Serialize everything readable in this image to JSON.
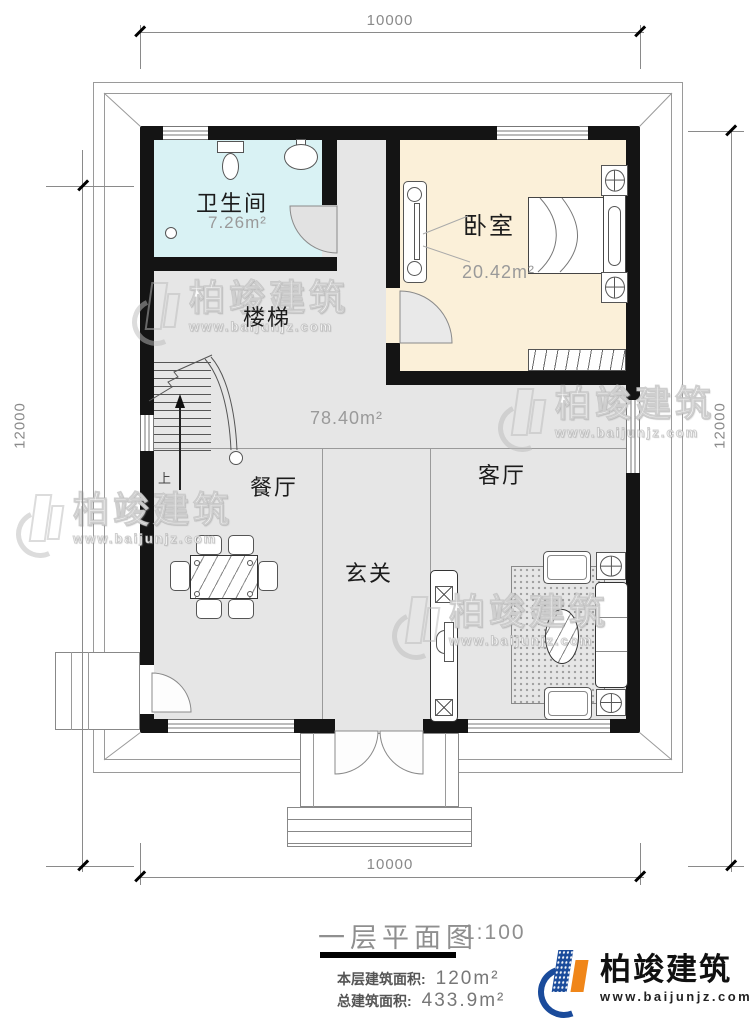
{
  "plan": {
    "dimensions": {
      "top": "10000",
      "bottom": "10000",
      "left": "12000",
      "right": "12000"
    },
    "rooms": {
      "bathroom": {
        "name": "卫生间",
        "area": "7.26m²"
      },
      "bedroom": {
        "name": "卧室",
        "area": "20.42m²"
      },
      "stairs": {
        "name": "楼梯",
        "direction": "上"
      },
      "hall": {
        "area": "78.40m²"
      },
      "dining": {
        "name": "餐厅"
      },
      "living": {
        "name": "客厅"
      },
      "foyer": {
        "name": "玄关"
      }
    }
  },
  "title_block": {
    "title": "一层平面图",
    "scale": "1:100",
    "floor_area_label": "本层建筑面积:",
    "floor_area_value": "120m²",
    "total_area_label": "总建筑面积:",
    "total_area_value": "433.9m²"
  },
  "watermark": {
    "text": "柏竣建筑",
    "url": "www.baijunjz.com"
  },
  "brand": {
    "name": "柏竣建筑",
    "url": "www.baijunjz.com"
  },
  "colors": {
    "wall": "#141414",
    "bathroom_floor": "#d9f2f4",
    "bedroom_floor": "#fbf0d9",
    "hall_floor": "#e6e6e6",
    "brand_blue": "#1a4b9b",
    "brand_orange": "#f08619"
  }
}
